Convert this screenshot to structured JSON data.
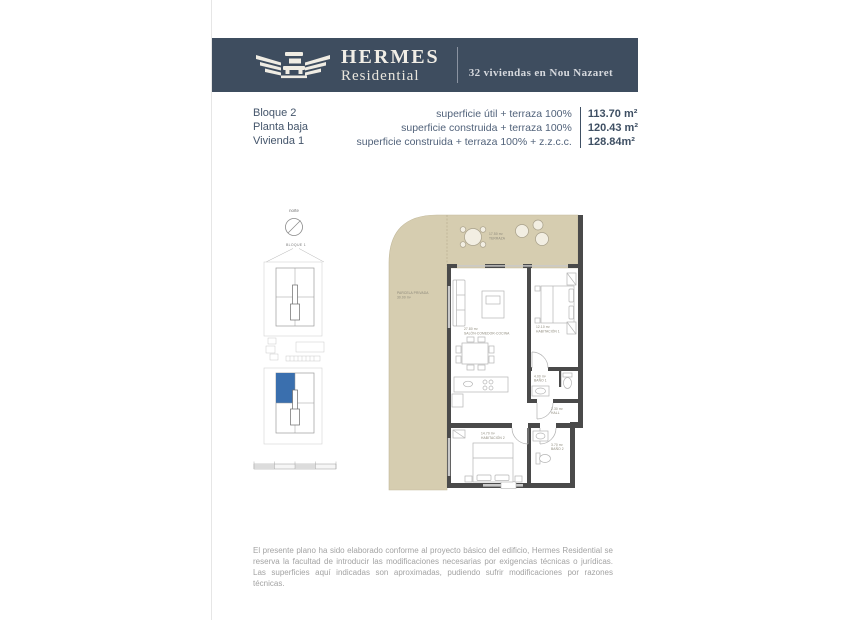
{
  "header": {
    "brand": "HERMES",
    "brand_sub": "Residential",
    "tagline": "32 viviendas en Nou Nazaret"
  },
  "info": {
    "unit_lines": [
      "Bloque 2",
      "Planta baja",
      "Vivienda 1"
    ],
    "surface_rows": [
      {
        "label": "superficie útil + terraza 100%",
        "value": "113.70 m²"
      },
      {
        "label": "superficie construida + terraza 100%",
        "value": "120.43 m²"
      },
      {
        "label": "superficie construida + terraza 100% + z.z.c.c.",
        "value": "128.84m²"
      }
    ]
  },
  "siteplan": {
    "north": "norte",
    "block": "BLOQUE 1"
  },
  "floorplan": {
    "parcela": {
      "label": "PARCELA PRIVADA",
      "area": "30.00 m²"
    },
    "terraza": {
      "label": "TERRAZA",
      "area": "17.50 m²"
    },
    "salon": {
      "label": "SALÓN-COMEDOR-COCINA",
      "area": "27.80 m²"
    },
    "habitacion1": {
      "label": "HABITACIÓN 1",
      "area": "12.10 m²"
    },
    "bano1": {
      "label": "BAÑO 1",
      "area": "4.00 m²"
    },
    "hall": {
      "label": "HALL",
      "area": "2.30 m²"
    },
    "habitacion2": {
      "label": "HABITACIÓN 2",
      "area": "14.70 m²"
    },
    "bano2": {
      "label": "BAÑO 2",
      "area": "3.70 m²"
    }
  },
  "colors": {
    "header_bg": "#3e4d5f",
    "outdoor_tan": "#d6cdb0",
    "highlight_blue": "#3a6fae",
    "wall_gray": "#4a4a4a"
  },
  "footer": {
    "disclaimer": "El presente plano ha sido elaborado conforme al proyecto básico del edificio, Hermes Residential se reserva la facultad de introducir las modificaciones necesarias por exigencias técnicas o jurídicas. Las superficies aquí indicadas son aproximadas, pudiendo sufrir modificaciones por razones técnicas."
  }
}
